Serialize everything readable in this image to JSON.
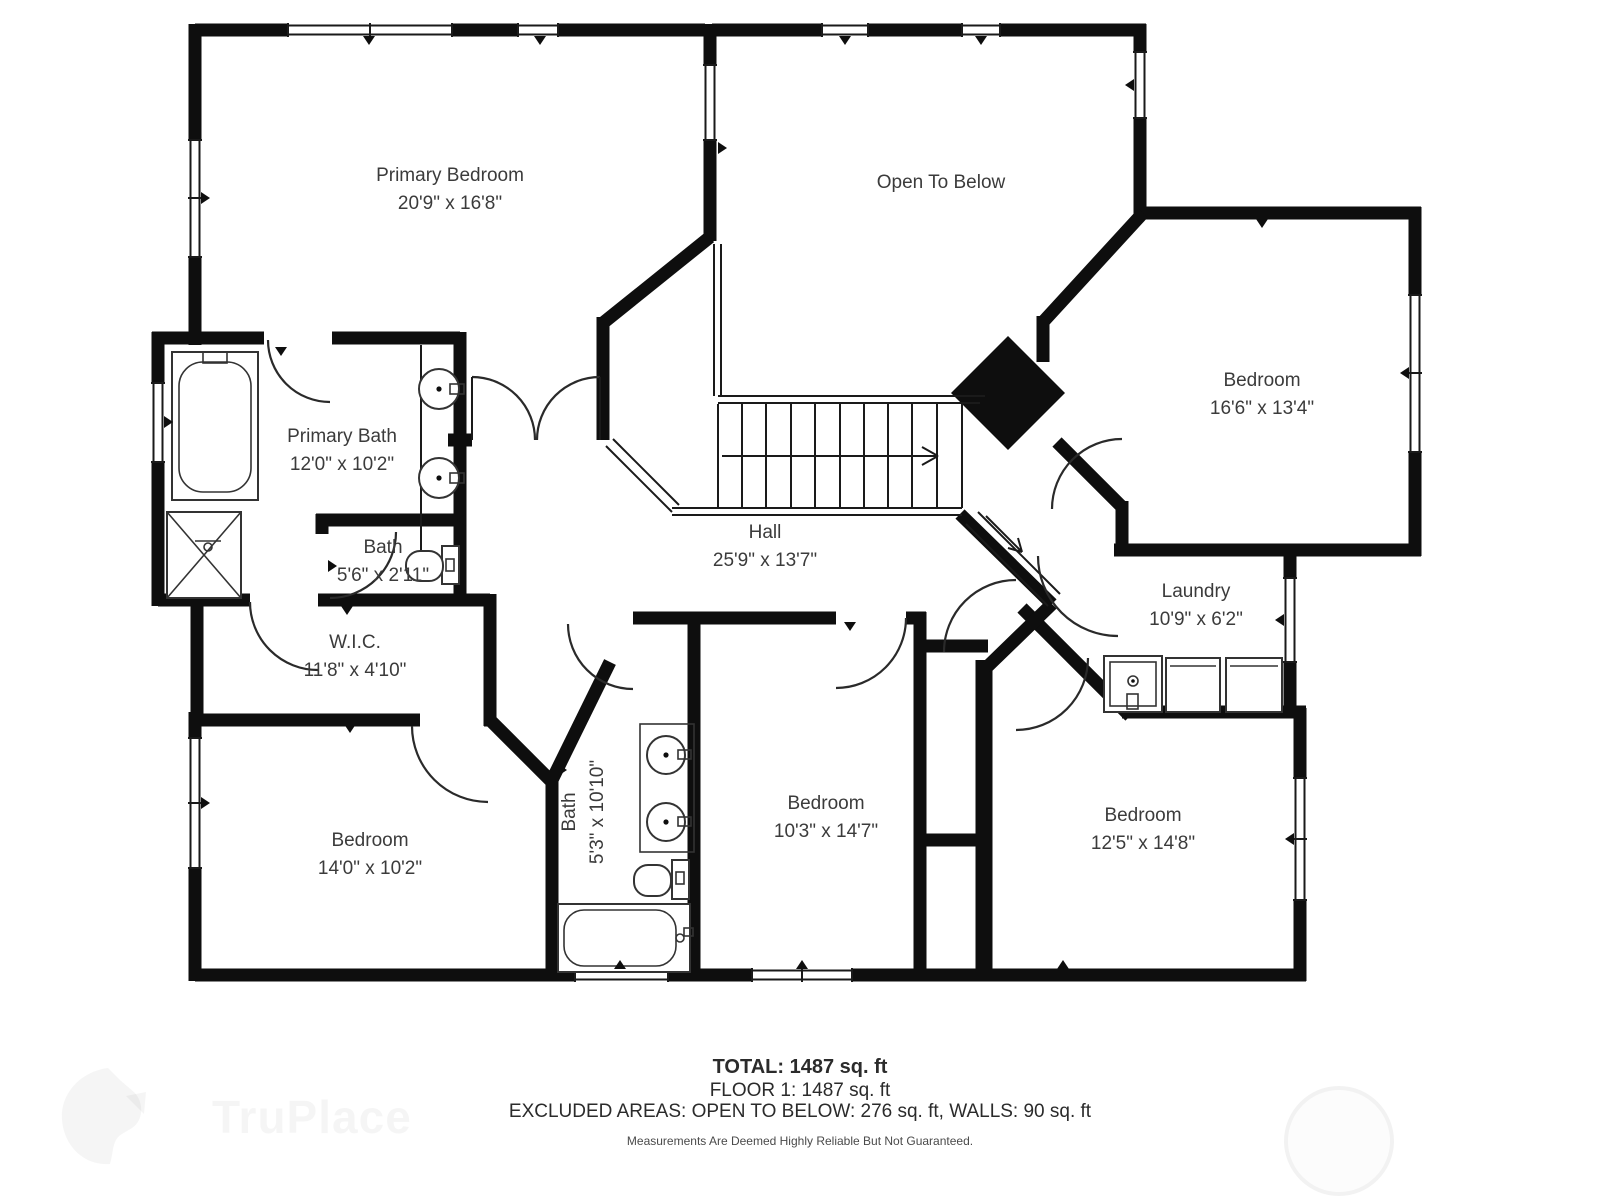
{
  "rooms": [
    {
      "name": "Primary Bedroom",
      "dims": "20'9\" x 16'8\""
    },
    {
      "name": "Open To Below",
      "dims": ""
    },
    {
      "name": "Bedroom",
      "dims": "16'6\" x 13'4\""
    },
    {
      "name": "Primary Bath",
      "dims": "12'0\" x 10'2\""
    },
    {
      "name": "Bath",
      "dims": "5'6\" x 2'11\""
    },
    {
      "name": "Hall",
      "dims": "25'9\" x 13'7\""
    },
    {
      "name": "W.I.C.",
      "dims": "11'8\" x 4'10\""
    },
    {
      "name": "Laundry",
      "dims": "10'9\" x 6'2\""
    },
    {
      "name": "Bedroom",
      "dims": "14'0\" x 10'2\""
    },
    {
      "name": "Bath",
      "dims": "5'3\" x 10'10\""
    },
    {
      "name": "Bedroom",
      "dims": "10'3\" x 14'7\""
    },
    {
      "name": "Bedroom",
      "dims": "12'5\" x 14'8\""
    }
  ],
  "summary": {
    "total": "TOTAL: 1487 sq. ft",
    "floor": "FLOOR 1: 1487 sq. ft",
    "excluded": "EXCLUDED AREAS: OPEN TO BELOW: 276 sq. ft, WALLS: 90 sq. ft",
    "disclaimer": "Measurements Are Deemed Highly Reliable But Not Guaranteed."
  },
  "watermark": {
    "brand": "TruPlace"
  },
  "colors": {
    "wall": "#0e0e0e",
    "label_text": "#3b3b3b",
    "background": "#ffffff"
  }
}
